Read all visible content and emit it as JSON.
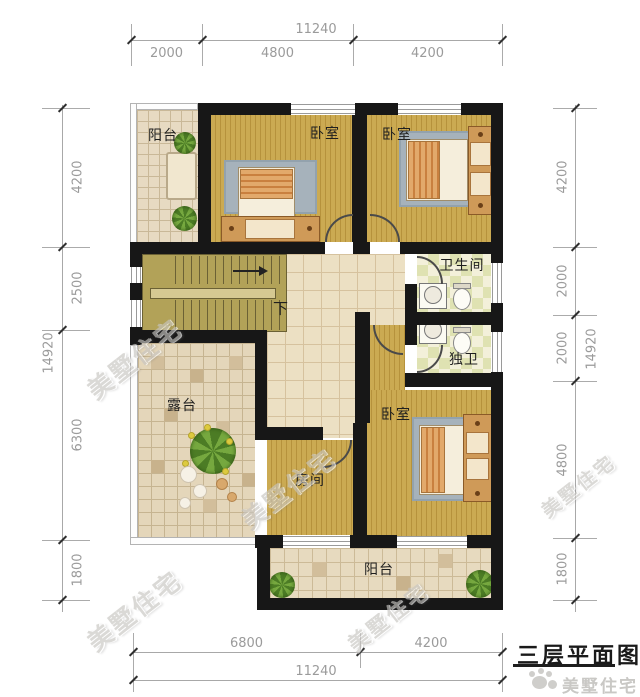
{
  "title": "三层平面图",
  "watermark_text": "美墅住宅",
  "logo_text": "美墅住宅",
  "rooms": {
    "balcony_top": "阳台",
    "bedroom_a": "卧室",
    "bedroom_b": "卧室",
    "bathroom": "卫生间",
    "ensuite": "独卫",
    "terrace": "露台",
    "bedroom_c": "卧室",
    "small_room": "房间",
    "balcony_bottom": "阳台",
    "stair_down": "下"
  },
  "dimensions": {
    "top": {
      "total": "11240",
      "segments": [
        "2000",
        "4800",
        "4200"
      ]
    },
    "bottom": {
      "total": "11240",
      "segments": [
        "6800",
        "4200"
      ]
    },
    "left": {
      "total": "14920",
      "segments": [
        "4200",
        "2500",
        "6300",
        "1800"
      ]
    },
    "right": {
      "total": "14920",
      "segments": [
        "4200",
        "2000",
        "2000",
        "4800",
        "1800"
      ]
    }
  },
  "colors": {
    "wall": "#171717",
    "wood_floor": "#c9a64f",
    "tile_floor": "#e6d9c0",
    "stair": "#b2a258",
    "bath_tile": "#e0e3b4",
    "dim_text": "#9b9b9b"
  }
}
